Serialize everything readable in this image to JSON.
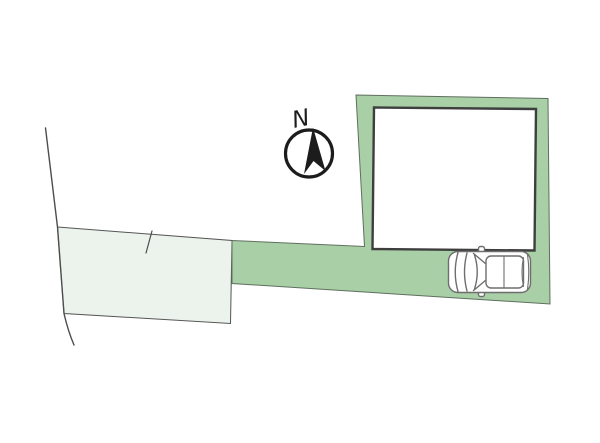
{
  "plan": {
    "type": "site-plan",
    "compass": {
      "label": "N",
      "icon": "north-arrow-icon"
    },
    "icons": {
      "compass": "north-arrow-icon",
      "vehicle": "car-top-view-icon"
    },
    "colors": {
      "background": "#ffffff",
      "site_green": "#a8cfa5",
      "parcel_light": "#ebf3ec",
      "boundary_line": "#4d4d4d",
      "site_outline": "#5f6f5f",
      "building_border": "#3e3e3e",
      "building_fill": "#ffffff",
      "compass_ink": "#1c1c1c",
      "car_line": "#6e6e6e",
      "car_fill": "#ffffff"
    }
  }
}
